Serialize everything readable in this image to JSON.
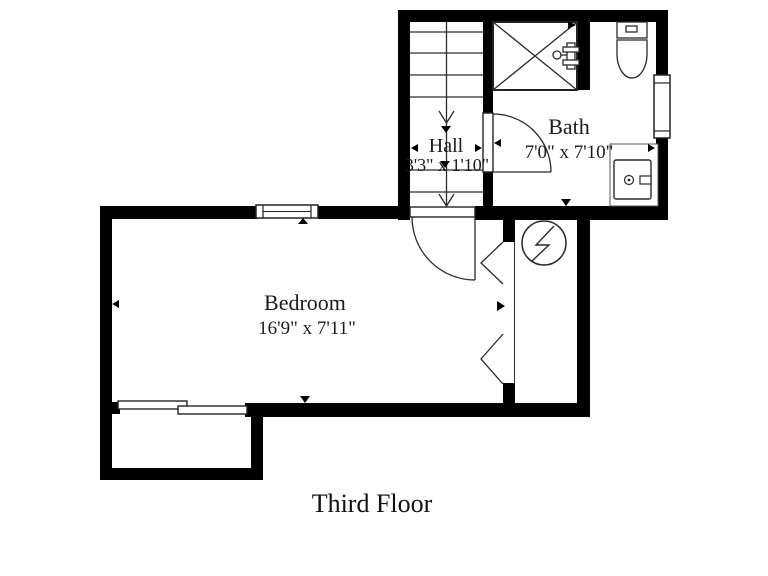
{
  "title": "Third Floor",
  "rooms": {
    "hall": {
      "name": "Hall",
      "dims": "3'3\" x 1'10\""
    },
    "bath": {
      "name": "Bath",
      "dims": "7'0\" x 7'10\""
    },
    "bedroom": {
      "name": "Bedroom",
      "dims": "16'9\" x 7'11\""
    }
  },
  "fixtures": {
    "stairs": "stairs-down",
    "shower": "shower",
    "shower_valve": "shower-valve",
    "toilet": "toilet",
    "sink": "sink-vanity",
    "electrical": "electrical-panel",
    "closet_doors": "bifold-closet-doors",
    "bedroom_door": "swing-door",
    "bath_door": "swing-door",
    "windows": "window",
    "slider": "sliding-door"
  },
  "colors": {
    "wall": "#000000",
    "background": "#ffffff",
    "line": "#2a2a2a",
    "text": "#1b1b1b"
  }
}
